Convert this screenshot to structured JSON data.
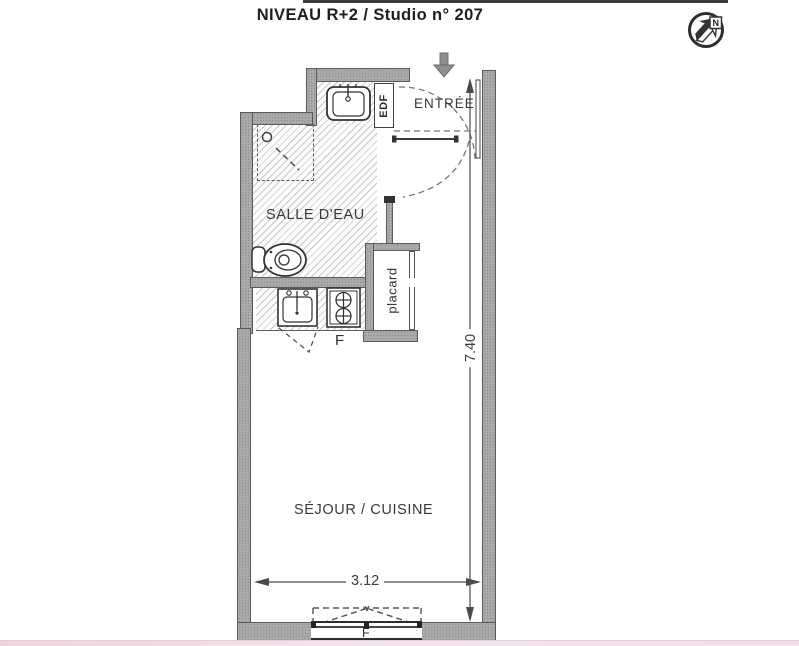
{
  "title": "NIVEAU R+2 / Studio n° 207",
  "compass": {
    "label": "N"
  },
  "plan": {
    "rooms": {
      "entree": "ENTRÉE",
      "salle_deau": "SALLE D'EAU",
      "sejour_cuisine": "SÉJOUR / CUISINE",
      "placard": "placard",
      "edf": "EDF"
    },
    "labels": {
      "fridge": "F",
      "window": "F"
    },
    "dimensions": {
      "width_m": "3.12",
      "height_m": "7.40"
    }
  },
  "colors": {
    "wall": "#a9a9a9",
    "hatch_line": "#c7c7c7",
    "drawing_line": "#3d3d3d",
    "accent_strip": "#f2e0ea"
  }
}
